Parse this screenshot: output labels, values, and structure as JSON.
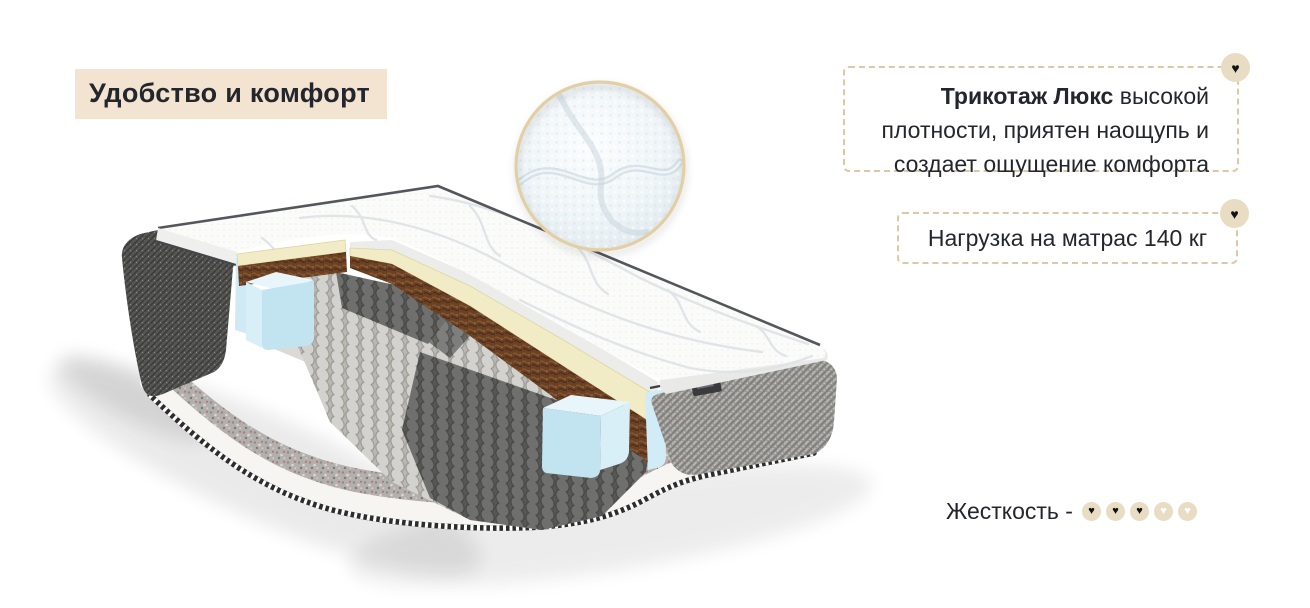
{
  "page": {
    "width": 1310,
    "height": 608,
    "background": "#ffffff"
  },
  "icons": {
    "heart": "♥"
  },
  "header": {
    "title": "Удобство и комфорт",
    "background": "#f3e4d2",
    "text_color": "#23262c"
  },
  "feature_box": {
    "text_bold": "Трикотаж Люкс",
    "text_rest": " высокой плотности, приятен наощупь и создает ощущение комфорта",
    "border_color": "#dbc8a6",
    "badge_icon": "heart-icon"
  },
  "load_box": {
    "text": "Нагрузка на матрас 140 кг",
    "border_color": "#dbc8a6",
    "badge_icon": "heart-icon"
  },
  "hardness": {
    "label": "Жесткость -",
    "filled": 3,
    "total": 5,
    "circle_color": "#e8dcc3",
    "filled_heart_color": "#111111",
    "empty_heart_color": "#ffffff"
  },
  "illustration": {
    "name": "mattress-cutaway",
    "parts": [
      "quilted-top-cover",
      "foam-comfort-layer",
      "coconut-coir-layer",
      "pocket-springs",
      "edge-support-foam-blocks",
      "felt-base-layer",
      "side-fabric-panels",
      "fabric-texture-magnifier"
    ]
  }
}
